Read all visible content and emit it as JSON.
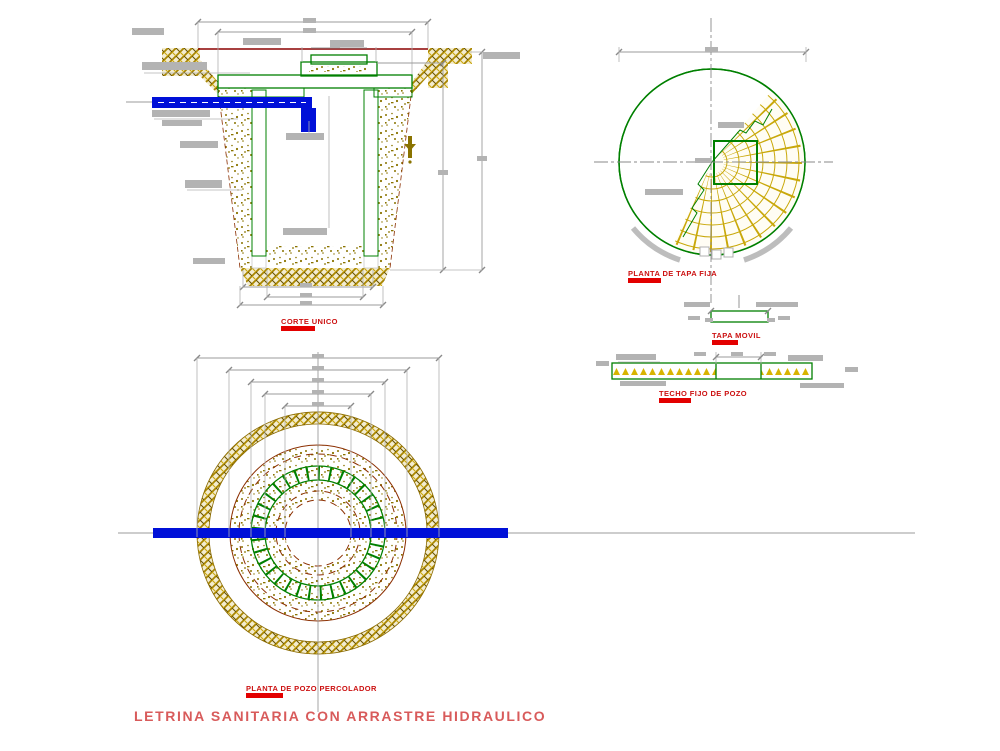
{
  "drawing": {
    "title": "LETRINA SANITARIA CON ARRASTRE HIDRAULICO",
    "views": {
      "corte_unico": {
        "label": "CORTE UNICO"
      },
      "planta_tapa_fija": {
        "label": "PLANTA DE TAPA FIJA"
      },
      "tapa_movil": {
        "label": "TAPA MOVIL"
      },
      "techo_fijo_pozo": {
        "label": "TECHO FIJO DE POZO"
      },
      "planta_pozo_percolador": {
        "label": "PLANTA DE POZO PERCOLADOR"
      }
    },
    "colors": {
      "earth_hatch_olive": "#8a7300",
      "masonry_green": "#008000",
      "grid_yellow": "#c9a80a",
      "pipe_blue": "#0010d8",
      "ground_line_red": "#8b0000",
      "detail_dark_red": "#8b2e00",
      "label_red": "#cc1111",
      "title_red": "#d85b5b",
      "dimension_gray": "#9b9b9b",
      "annotation_gray": "#b3b3b3"
    }
  }
}
